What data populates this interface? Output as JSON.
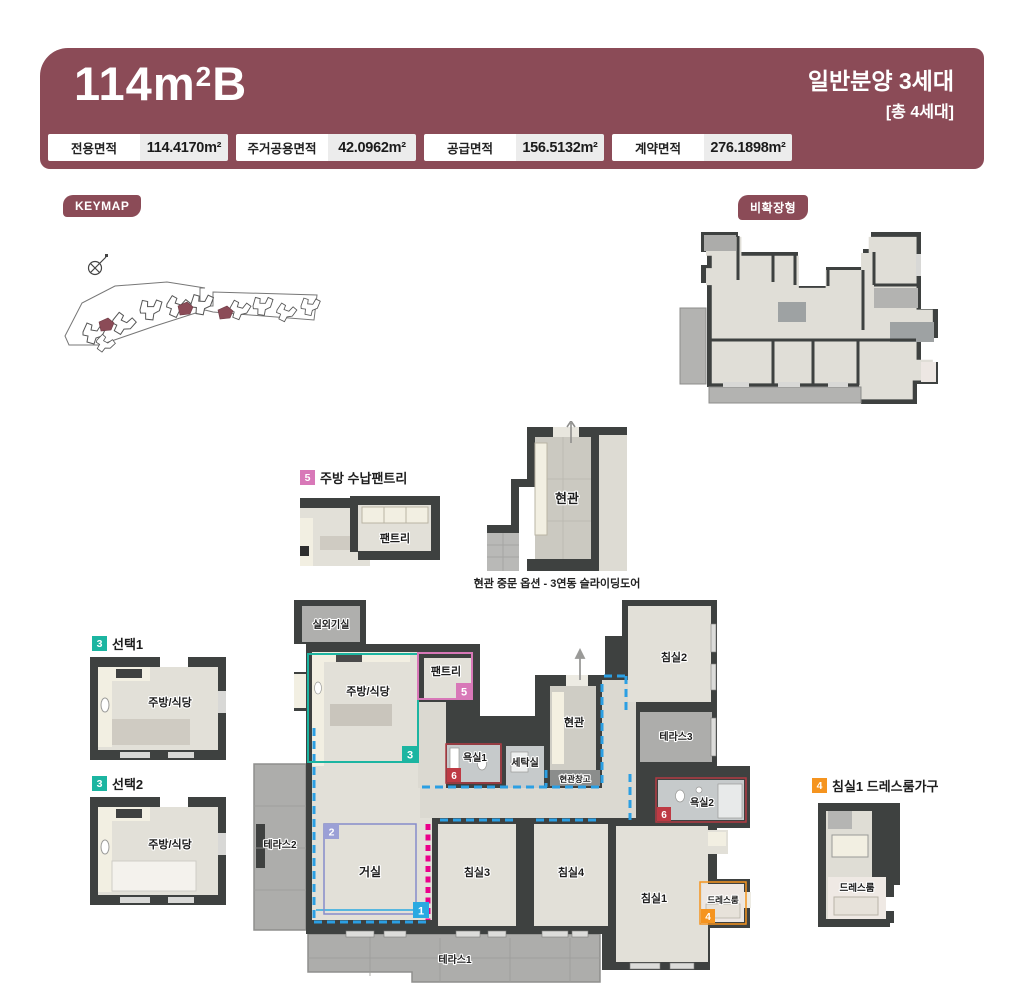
{
  "colors": {
    "maroon": "#8B4B57",
    "wall": "#3E4140",
    "floor": "#E2E0D8",
    "terrace": "#ADADAB",
    "bath": "#C6CACB",
    "cream": "#F2EFE2",
    "dash_blue": "#2B9FE3",
    "magenta": "#EB008B",
    "teal": "#1CB5A1",
    "pink": "#D878B8",
    "red": "#BE3A44",
    "orange": "#F5941F",
    "purple": "#8A90CE",
    "blue": "#29A9E1"
  },
  "header": {
    "title_main": "114m",
    "title_sup": "2",
    "title_suffix": "B",
    "right_line1": "일반분양 3세대",
    "right_line2": "[총 4세대]",
    "areas": [
      {
        "label": "전용면적",
        "value": "114.4170m²"
      },
      {
        "label": "주거공용면적",
        "value": "42.0962m²"
      },
      {
        "label": "공급면적",
        "value": "156.5132m²"
      },
      {
        "label": "계약면적",
        "value": "276.1898m²"
      }
    ]
  },
  "badges": {
    "keymap": "KEYMAP",
    "non_expanded": "비확장형"
  },
  "details": {
    "pantry_option": {
      "num": "5",
      "title": "주방 수납팬트리",
      "room_label": "팬트리"
    },
    "entrance_option": {
      "room_label": "현관",
      "caption": "현관 중문 옵션 - 3연동 슬라이딩도어"
    },
    "choice1": {
      "num": "3",
      "title": "선택1",
      "room_label": "주방/식당"
    },
    "choice2": {
      "num": "3",
      "title": "선택2",
      "room_label": "주방/식당"
    },
    "dressroom_option": {
      "num": "4",
      "title": "침실1 드레스룸가구",
      "room_label": "드레스룸"
    }
  },
  "floorplan": {
    "rooms": [
      {
        "label": "실외기실"
      },
      {
        "label": "주방/식당"
      },
      {
        "label": "팬트리"
      },
      {
        "label": "욕실1"
      },
      {
        "label": "세탁실"
      },
      {
        "label": "현관"
      },
      {
        "label": "현관창고"
      },
      {
        "label": "침실2"
      },
      {
        "label": "테라스3"
      },
      {
        "label": "욕실2"
      },
      {
        "label": "테라스2"
      },
      {
        "label": "거실"
      },
      {
        "label": "침실3"
      },
      {
        "label": "침실4"
      },
      {
        "label": "침실1"
      },
      {
        "label": "드레스룸"
      },
      {
        "label": "테라스1"
      }
    ],
    "markers": [
      {
        "num": "1",
        "color": "#29A9E1"
      },
      {
        "num": "2",
        "color": "#9BA0D6"
      },
      {
        "num": "3",
        "color": "#1CB5A1"
      },
      {
        "num": "4",
        "color": "#F5941F"
      },
      {
        "num": "5",
        "color": "#D878B8"
      },
      {
        "num": "6",
        "color": "#BE3A44"
      }
    ]
  }
}
